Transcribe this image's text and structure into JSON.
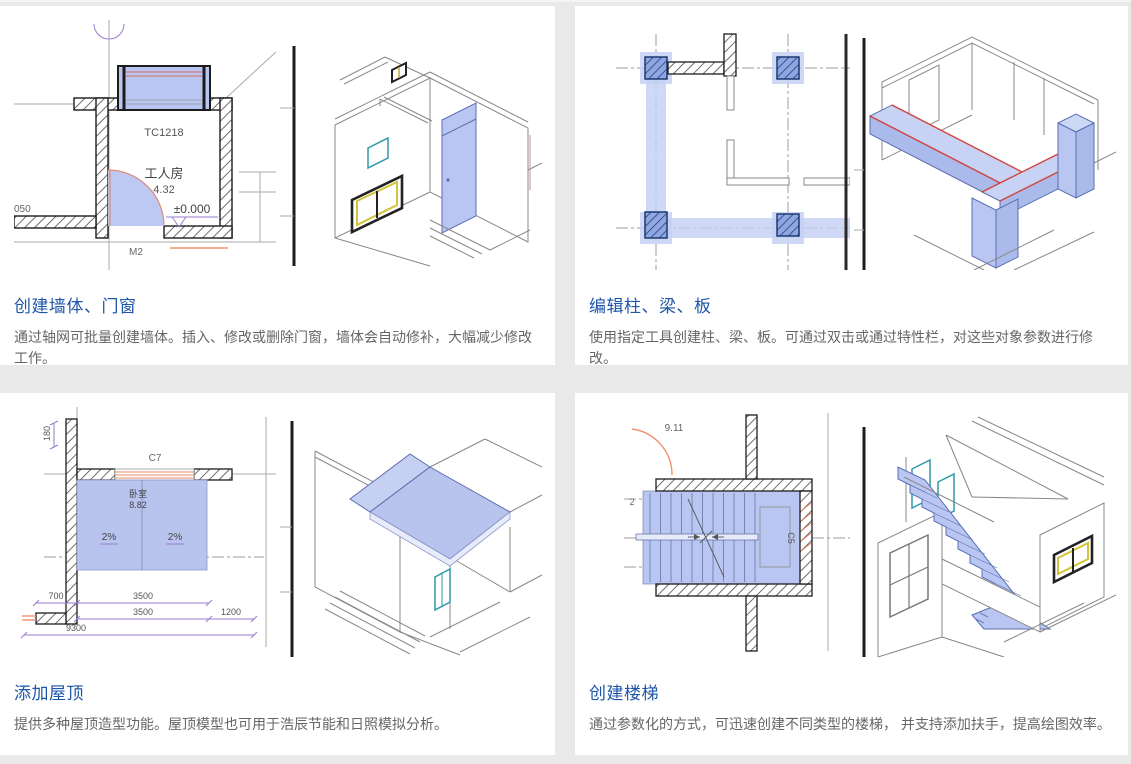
{
  "page": {
    "background": "#e9e9e9",
    "panel_background": "#ffffff",
    "accent_color": "#1e56a8",
    "body_text_color": "#666666",
    "highlight_blue": "#b9c6f2",
    "highlight_red": "#d6453c",
    "highlight_orange": "#f09070",
    "highlight_teal": "#2e9aa8",
    "dimension_purple": "#9a7bd0"
  },
  "features": [
    {
      "id": "walls",
      "title": "创建墙体、门窗",
      "description": "通过轴网可批量创建墙体。插入、修改或删除门窗，墙体会自动修补，大幅减少修改工作。",
      "plan": {
        "window_tag": "TC1218",
        "room_name": "工人房",
        "room_area": "4.32",
        "level_mark": "±0.000",
        "door_tag": "M2",
        "left_partial_label": "050"
      }
    },
    {
      "id": "columns",
      "title": "编辑柱、梁、板",
      "description": "使用指定工具创建柱、梁、板。可通过双击或通过特性栏，对这些对象参数进行修改。",
      "plan": {}
    },
    {
      "id": "roof",
      "title": "添加屋顶",
      "description": "提供多种屋顶造型功能。屋顶模型也可用于浩辰节能和日照模拟分析。",
      "plan": {
        "window_tag": "C7",
        "room_name": "卧室",
        "room_area": "8.82",
        "slope_left": "2%",
        "slope_right": "2%",
        "dim_180": "180",
        "dim_700": "700",
        "dim_3500_a": "3500",
        "dim_3500_b": "3500",
        "dim_1200": "1200",
        "dim_9300": "9300"
      }
    },
    {
      "id": "stairs",
      "title": "创建楼梯",
      "description": "通过参数化的方式，可迅速创建不同类型的楼梯， 并支持添加扶手，提高绘图效率。",
      "plan": {
        "level_mark": "9.11",
        "grid_label": "2",
        "window_tag": "C5"
      }
    }
  ]
}
